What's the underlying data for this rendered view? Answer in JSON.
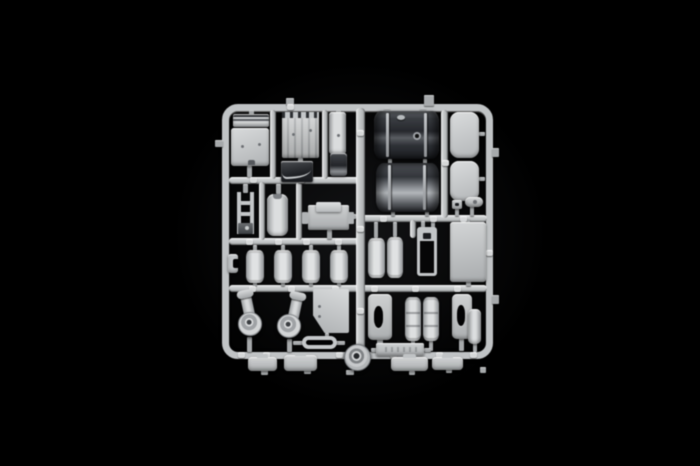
{
  "image": {
    "type": "studio product photo",
    "subject": "injection-molded plastic model-kit sprue (parts tree) of truck accessory parts: two large dark fuel tanks, rounded panels, air reservoirs, air-cleaner housings, brackets, cylinders and small trays",
    "background_color": "#000000",
    "palette": {
      "light_plastic": "#c3c6c8",
      "highlight": "#e8eaea",
      "shadow": "#7e8184",
      "dark_plastic": "#26282d",
      "black_backdrop": "#000000"
    }
  },
  "sprue": {
    "frame": {
      "x": 222,
      "y": 104,
      "w": 271,
      "h": 255,
      "thickness": 7,
      "radius": 16
    },
    "rails": [
      {
        "name": "runner-mid-left-upper",
        "kind": "rail-h",
        "x": 229,
        "y": 177,
        "w": 130,
        "h": 7
      },
      {
        "name": "runner-mid-left-lower",
        "kind": "rail-h",
        "x": 229,
        "y": 238,
        "w": 136,
        "h": 7
      },
      {
        "name": "runner-lower-full",
        "kind": "rail-h",
        "x": 229,
        "y": 285,
        "w": 258,
        "h": 7
      },
      {
        "name": "runner-mid-right",
        "kind": "rail-h",
        "x": 362,
        "y": 215,
        "w": 125,
        "h": 7
      },
      {
        "name": "runner-center-vertical",
        "kind": "rail-v",
        "x": 356,
        "y": 108,
        "w": 9,
        "h": 245
      },
      {
        "name": "runner-right-inner-vertical",
        "kind": "rail-v",
        "x": 441,
        "y": 110,
        "w": 7,
        "h": 108
      },
      {
        "name": "runner-link-a",
        "kind": "rail-v",
        "x": 270,
        "y": 110,
        "w": 6,
        "h": 69
      },
      {
        "name": "runner-link-b",
        "kind": "rail-v",
        "x": 322,
        "y": 110,
        "w": 6,
        "h": 69
      },
      {
        "name": "runner-link-c",
        "kind": "rail-v",
        "x": 259,
        "y": 182,
        "w": 6,
        "h": 58
      },
      {
        "name": "runner-link-d",
        "kind": "rail-v",
        "x": 296,
        "y": 182,
        "w": 6,
        "h": 58
      },
      {
        "name": "runner-link-e",
        "kind": "rail-v",
        "x": 410,
        "y": 220,
        "w": 6,
        "h": 18
      }
    ],
    "stubs": [
      [
        249,
        110,
        5,
        5
      ],
      [
        336,
        110,
        5,
        4
      ],
      [
        286,
        98,
        8,
        7
      ],
      [
        424,
        95,
        10,
        11
      ],
      [
        215,
        140,
        8,
        7
      ],
      [
        247,
        166,
        5,
        11
      ],
      [
        298,
        158,
        5,
        5
      ],
      [
        243,
        184,
        5,
        9
      ],
      [
        276,
        184,
        5,
        10
      ],
      [
        303,
        213,
        6,
        5
      ],
      [
        327,
        230,
        5,
        9
      ],
      [
        349,
        214,
        7,
        5
      ],
      [
        253,
        245,
        4,
        6
      ],
      [
        281,
        245,
        4,
        6
      ],
      [
        309,
        245,
        4,
        6
      ],
      [
        337,
        245,
        4,
        6
      ],
      [
        253,
        282,
        4,
        4
      ],
      [
        281,
        282,
        4,
        4
      ],
      [
        309,
        282,
        4,
        4
      ],
      [
        337,
        282,
        4,
        4
      ],
      [
        247,
        337,
        5,
        15
      ],
      [
        287,
        339,
        5,
        13
      ],
      [
        325,
        333,
        4,
        5
      ],
      [
        293,
        341,
        10,
        4
      ],
      [
        336,
        341,
        9,
        4
      ],
      [
        260,
        356,
        5,
        4
      ],
      [
        297,
        354,
        5,
        4
      ],
      [
        404,
        356,
        5,
        4
      ],
      [
        419,
        356,
        5,
        4
      ],
      [
        443,
        356,
        5,
        4
      ],
      [
        261,
        370,
        7,
        5
      ],
      [
        304,
        370,
        7,
        4
      ],
      [
        346,
        370,
        8,
        5
      ],
      [
        409,
        371,
        6,
        4
      ],
      [
        446,
        369,
        6,
        4
      ],
      [
        480,
        367,
        6,
        6
      ],
      [
        384,
        108,
        6,
        5
      ],
      [
        420,
        108,
        6,
        5
      ],
      [
        388,
        159,
        4,
        5
      ],
      [
        423,
        159,
        4,
        5
      ],
      [
        391,
        211,
        4,
        5
      ],
      [
        425,
        211,
        4,
        5
      ],
      [
        479,
        132,
        6,
        4
      ],
      [
        479,
        177,
        6,
        4
      ],
      [
        455,
        208,
        4,
        8
      ],
      [
        470,
        206,
        4,
        10
      ],
      [
        374,
        222,
        4,
        16
      ],
      [
        393,
        222,
        4,
        15
      ],
      [
        421,
        221,
        4,
        7
      ],
      [
        431,
        221,
        4,
        7
      ],
      [
        466,
        218,
        4,
        5
      ],
      [
        466,
        281,
        5,
        5
      ],
      [
        377,
        339,
        6,
        13
      ],
      [
        411,
        340,
        4,
        11
      ],
      [
        429,
        340,
        4,
        11
      ],
      [
        459,
        338,
        5,
        13
      ],
      [
        473,
        343,
        4,
        9
      ],
      [
        371,
        348,
        6,
        4
      ],
      [
        424,
        348,
        7,
        4
      ],
      [
        492,
        148,
        7,
        9
      ],
      [
        492,
        295,
        7,
        9
      ]
    ],
    "tabs": [
      [
        287,
        104
      ],
      [
        250,
        177
      ],
      [
        298,
        177
      ],
      [
        246,
        239
      ],
      [
        275,
        239
      ],
      [
        303,
        239
      ],
      [
        335,
        239
      ],
      [
        249,
        286
      ],
      [
        288,
        286
      ],
      [
        332,
        286
      ],
      [
        371,
        286
      ],
      [
        412,
        286
      ],
      [
        454,
        286
      ],
      [
        238,
        352
      ],
      [
        263,
        352
      ],
      [
        298,
        352
      ],
      [
        336,
        352
      ],
      [
        390,
        352
      ],
      [
        436,
        352
      ],
      [
        470,
        352
      ],
      [
        357,
        130
      ],
      [
        357,
        226
      ],
      [
        357,
        308
      ],
      [
        442,
        160
      ],
      [
        486,
        250
      ],
      [
        380,
        216
      ],
      [
        430,
        216
      ],
      [
        460,
        216
      ]
    ],
    "parts": [
      {
        "name": "sun-visor-bar",
        "kind": "visor",
        "x": 233,
        "y": 114,
        "w": 36,
        "h": 13
      },
      {
        "name": "cab-floor-panel",
        "kind": "panel",
        "x": 231,
        "y": 128,
        "w": 38,
        "h": 38,
        "dots": [
          [
            10,
            17
          ],
          [
            27,
            15
          ]
        ]
      },
      {
        "name": "ribbed-rear-panel",
        "kind": "ribbed",
        "x": 282,
        "y": 112,
        "w": 37,
        "h": 46,
        "dots": [
          [
            10,
            21
          ],
          [
            27,
            17
          ]
        ]
      },
      {
        "name": "narrow-side-strip",
        "kind": "strip",
        "x": 329,
        "y": 112,
        "w": 17,
        "h": 42,
        "dots": [
          [
            8,
            22
          ]
        ]
      },
      {
        "name": "dark-sleeve-part",
        "kind": "darksleeve",
        "x": 330,
        "y": 153,
        "w": 17,
        "h": 23
      },
      {
        "name": "dark-fender-wedge",
        "kind": "darkwedge",
        "x": 281,
        "y": 161,
        "w": 32,
        "h": 21
      },
      {
        "name": "ladder-frame-part",
        "kind": "ladder",
        "x": 237,
        "y": 192,
        "w": 17,
        "h": 42
      },
      {
        "name": "small-tall-tank",
        "kind": "talltank",
        "x": 267,
        "y": 194,
        "w": 21,
        "h": 42
      },
      {
        "name": "battery-box",
        "kind": "enginebox",
        "x": 308,
        "y": 205,
        "w": 41,
        "h": 25
      },
      {
        "name": "c-bracket",
        "kind": "cbracket",
        "x": 228,
        "y": 254,
        "w": 10,
        "h": 19
      },
      {
        "name": "air-reservoir-1",
        "kind": "cyl",
        "x": 246,
        "y": 250,
        "w": 18,
        "h": 33
      },
      {
        "name": "air-reservoir-2",
        "kind": "cyl",
        "x": 274,
        "y": 250,
        "w": 18,
        "h": 33
      },
      {
        "name": "air-reservoir-3",
        "kind": "cyl",
        "x": 302,
        "y": 250,
        "w": 18,
        "h": 33
      },
      {
        "name": "air-reservoir-4",
        "kind": "cyl",
        "x": 330,
        "y": 250,
        "w": 18,
        "h": 33
      },
      {
        "name": "fuel-tank-dark-upper",
        "kind": "bigtank1",
        "x": 374,
        "y": 111,
        "w": 65,
        "h": 48,
        "straps": [
          12,
          50
        ]
      },
      {
        "name": "fuel-tank-dark-lower",
        "kind": "bigtank2",
        "x": 376,
        "y": 163,
        "w": 63,
        "h": 49,
        "straps": [
          12,
          47
        ]
      },
      {
        "name": "rounded-panel-upper",
        "kind": "roundpanel",
        "x": 450,
        "y": 112,
        "w": 29,
        "h": 46
      },
      {
        "name": "rounded-panel-lower",
        "kind": "roundpanel",
        "x": 450,
        "y": 161,
        "w": 29,
        "h": 40
      },
      {
        "name": "small-clip-part",
        "kind": "clip",
        "x": 452,
        "y": 200,
        "w": 10,
        "h": 9
      },
      {
        "name": "small-bone-part",
        "kind": "bone",
        "x": 465,
        "y": 197,
        "w": 18,
        "h": 10
      },
      {
        "name": "twin-cylinder-left",
        "kind": "cyl",
        "x": 368,
        "y": 238,
        "w": 17,
        "h": 40
      },
      {
        "name": "twin-cylinder-right",
        "kind": "cyl",
        "x": 387,
        "y": 237,
        "w": 16,
        "h": 41
      },
      {
        "name": "open-frame-part",
        "kind": "openframe",
        "x": 417,
        "y": 227,
        "w": 20,
        "h": 49
      },
      {
        "name": "large-flat-panel",
        "kind": "bigpanel",
        "x": 450,
        "y": 222,
        "w": 36,
        "h": 60
      },
      {
        "name": "air-cleaner-left",
        "kind": "aircleaner",
        "x": 235,
        "y": 293,
        "w": 30,
        "h": 45,
        "tube": [
          5,
          0,
          -12
        ],
        "disc": [
          3,
          19,
          24
        ]
      },
      {
        "name": "air-cleaner-right",
        "kind": "aircleaner",
        "x": 276,
        "y": 295,
        "w": 30,
        "h": 45,
        "tube": [
          16,
          0,
          12
        ],
        "disc": [
          1,
          19,
          24
        ]
      },
      {
        "name": "clipped-corner-panel",
        "kind": "pentagon",
        "x": 313,
        "y": 289,
        "w": 36,
        "h": 44,
        "dots": [
          [
            5,
            16
          ],
          [
            5,
            26
          ]
        ]
      },
      {
        "name": "oval-ring-part",
        "kind": "ovalring",
        "x": 302,
        "y": 336,
        "w": 35,
        "h": 13
      },
      {
        "name": "round-hub-part",
        "kind": "wheel",
        "x": 344,
        "y": 344,
        "w": 27,
        "h": 27
      },
      {
        "name": "step-bracket-left",
        "kind": "bracketoval",
        "x": 368,
        "y": 294,
        "w": 24,
        "h": 46,
        "oval": [
          6,
          12,
          9,
          22
        ]
      },
      {
        "name": "ribbed-cylinder-1",
        "kind": "ribcyl",
        "x": 405,
        "y": 297,
        "w": 16,
        "h": 44
      },
      {
        "name": "ribbed-cylinder-2",
        "kind": "ribcyl",
        "x": 423,
        "y": 297,
        "w": 16,
        "h": 44
      },
      {
        "name": "step-bracket-right",
        "kind": "bracketoval",
        "x": 452,
        "y": 294,
        "w": 20,
        "h": 45,
        "oval": [
          5,
          11,
          8,
          21
        ]
      },
      {
        "name": "small-cylinder",
        "kind": "smallcyl",
        "x": 468,
        "y": 309,
        "w": 13,
        "h": 35
      },
      {
        "name": "sprue-label-plate",
        "kind": "labelplate",
        "x": 376,
        "y": 343,
        "w": 48,
        "h": 13
      },
      {
        "name": "bottom-tray-1",
        "kind": "tray",
        "x": 248,
        "y": 357,
        "w": 29,
        "h": 14
      },
      {
        "name": "bottom-tray-2",
        "kind": "tray",
        "x": 284,
        "y": 355,
        "w": 33,
        "h": 16
      },
      {
        "name": "bottom-tray-3",
        "kind": "tray",
        "x": 391,
        "y": 357,
        "w": 37,
        "h": 14
      },
      {
        "name": "bottom-tray-4",
        "kind": "tray",
        "x": 432,
        "y": 357,
        "w": 31,
        "h": 13
      }
    ]
  }
}
